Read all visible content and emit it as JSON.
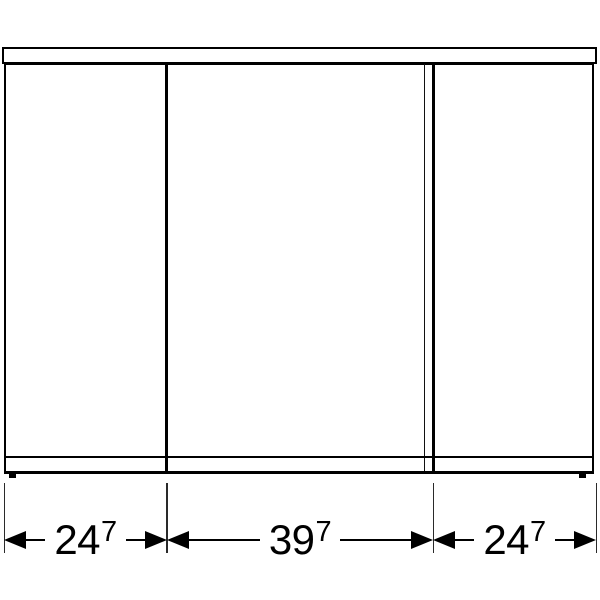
{
  "colors": {
    "line": "#000000",
    "background": "#ffffff"
  },
  "cabinet": {
    "door_count": 3
  },
  "dimensions": [
    {
      "id": "left-section-width",
      "value": "24",
      "superscript": "7"
    },
    {
      "id": "middle-section-width",
      "value": "39",
      "superscript": "7"
    },
    {
      "id": "right-section-width",
      "value": "24",
      "superscript": "7"
    }
  ]
}
